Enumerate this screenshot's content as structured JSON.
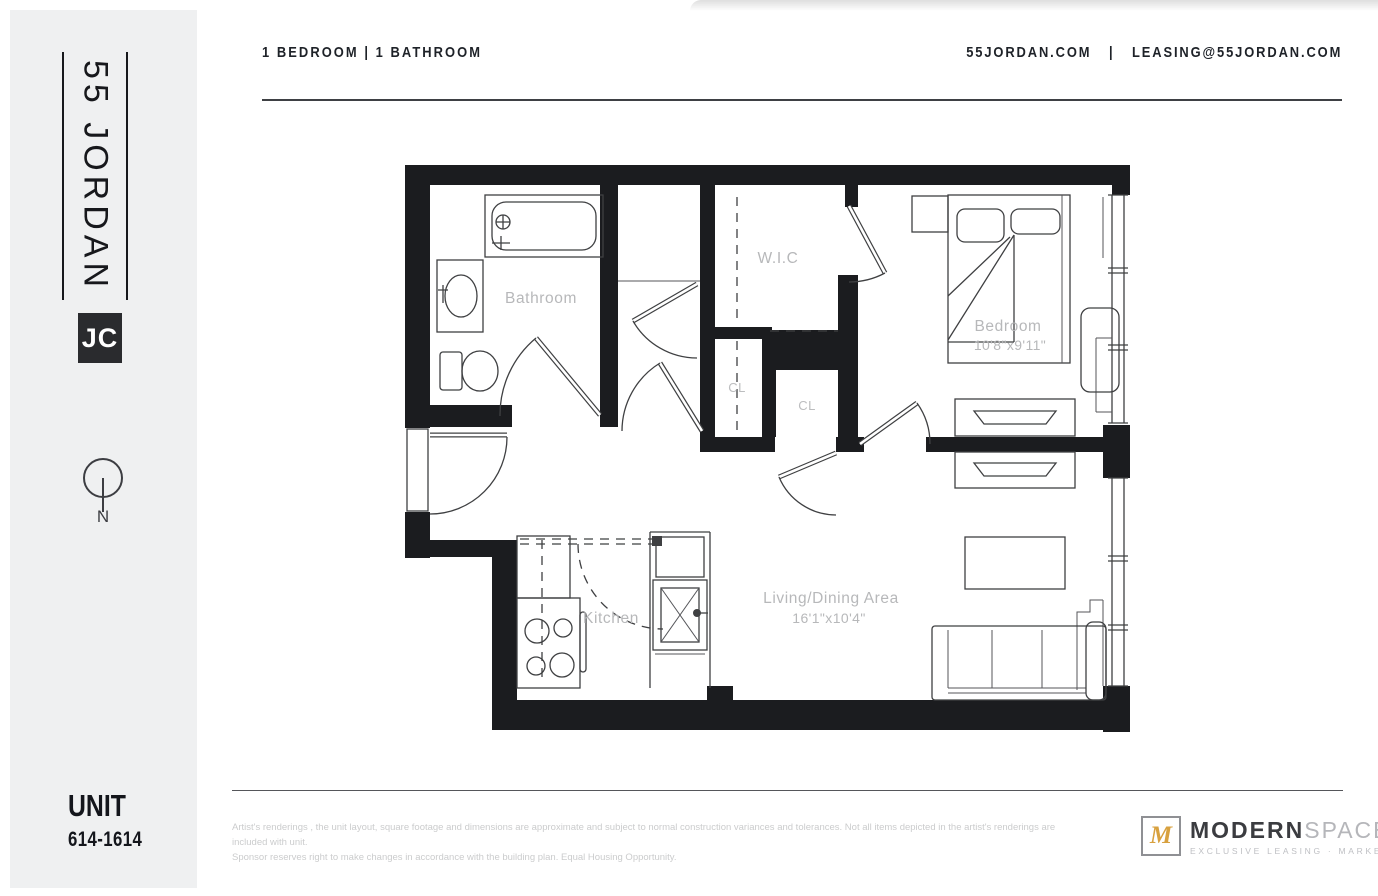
{
  "header": {
    "unit_type": "1 BEDROOM  |  1 BATHROOM",
    "website": "55JORDAN.COM",
    "separator": "|",
    "email": "LEASING@55JORDAN.COM"
  },
  "sidebar": {
    "brand": "55 JORDAN",
    "badge": "JC",
    "compass": "N",
    "unit_label": "UNIT",
    "unit_number": "614-1614"
  },
  "floorplan": {
    "rooms": {
      "bathroom": "Bathroom",
      "wic": "W.I.C",
      "cl1": "CL",
      "cl2": "CL",
      "bedroom": "Bedroom",
      "bedroom_dim": "10'8\"x9'11\"",
      "kitchen": "Kitchen",
      "living": "Living/Dining Area",
      "living_dim": "16'1\"x10'4\""
    }
  },
  "footer": {
    "disclaimer_line1": "Artist's renderings , the unit layout, square footage and dimensions are approximate and subject to normal construction variances and tolerances. Not all items depicted in the artist's renderings are included with unit.",
    "disclaimer_line2": "Sponsor reserves right to make changes in accordance with the building plan. Equal Housing Opportunity.",
    "logo": {
      "monogram": "M",
      "name_bold": "MODERN",
      "name_light": "SPACES",
      "tagline": "EXCLUSIVE LEASING · MARKETING"
    }
  },
  "colors": {
    "wall": "#1b1c1f",
    "line": "#3f4042",
    "label": "#b7b8ba",
    "gold": "#d8a13f",
    "sidebar_bg": "#eff0f1",
    "header_text": "#1e2228"
  }
}
